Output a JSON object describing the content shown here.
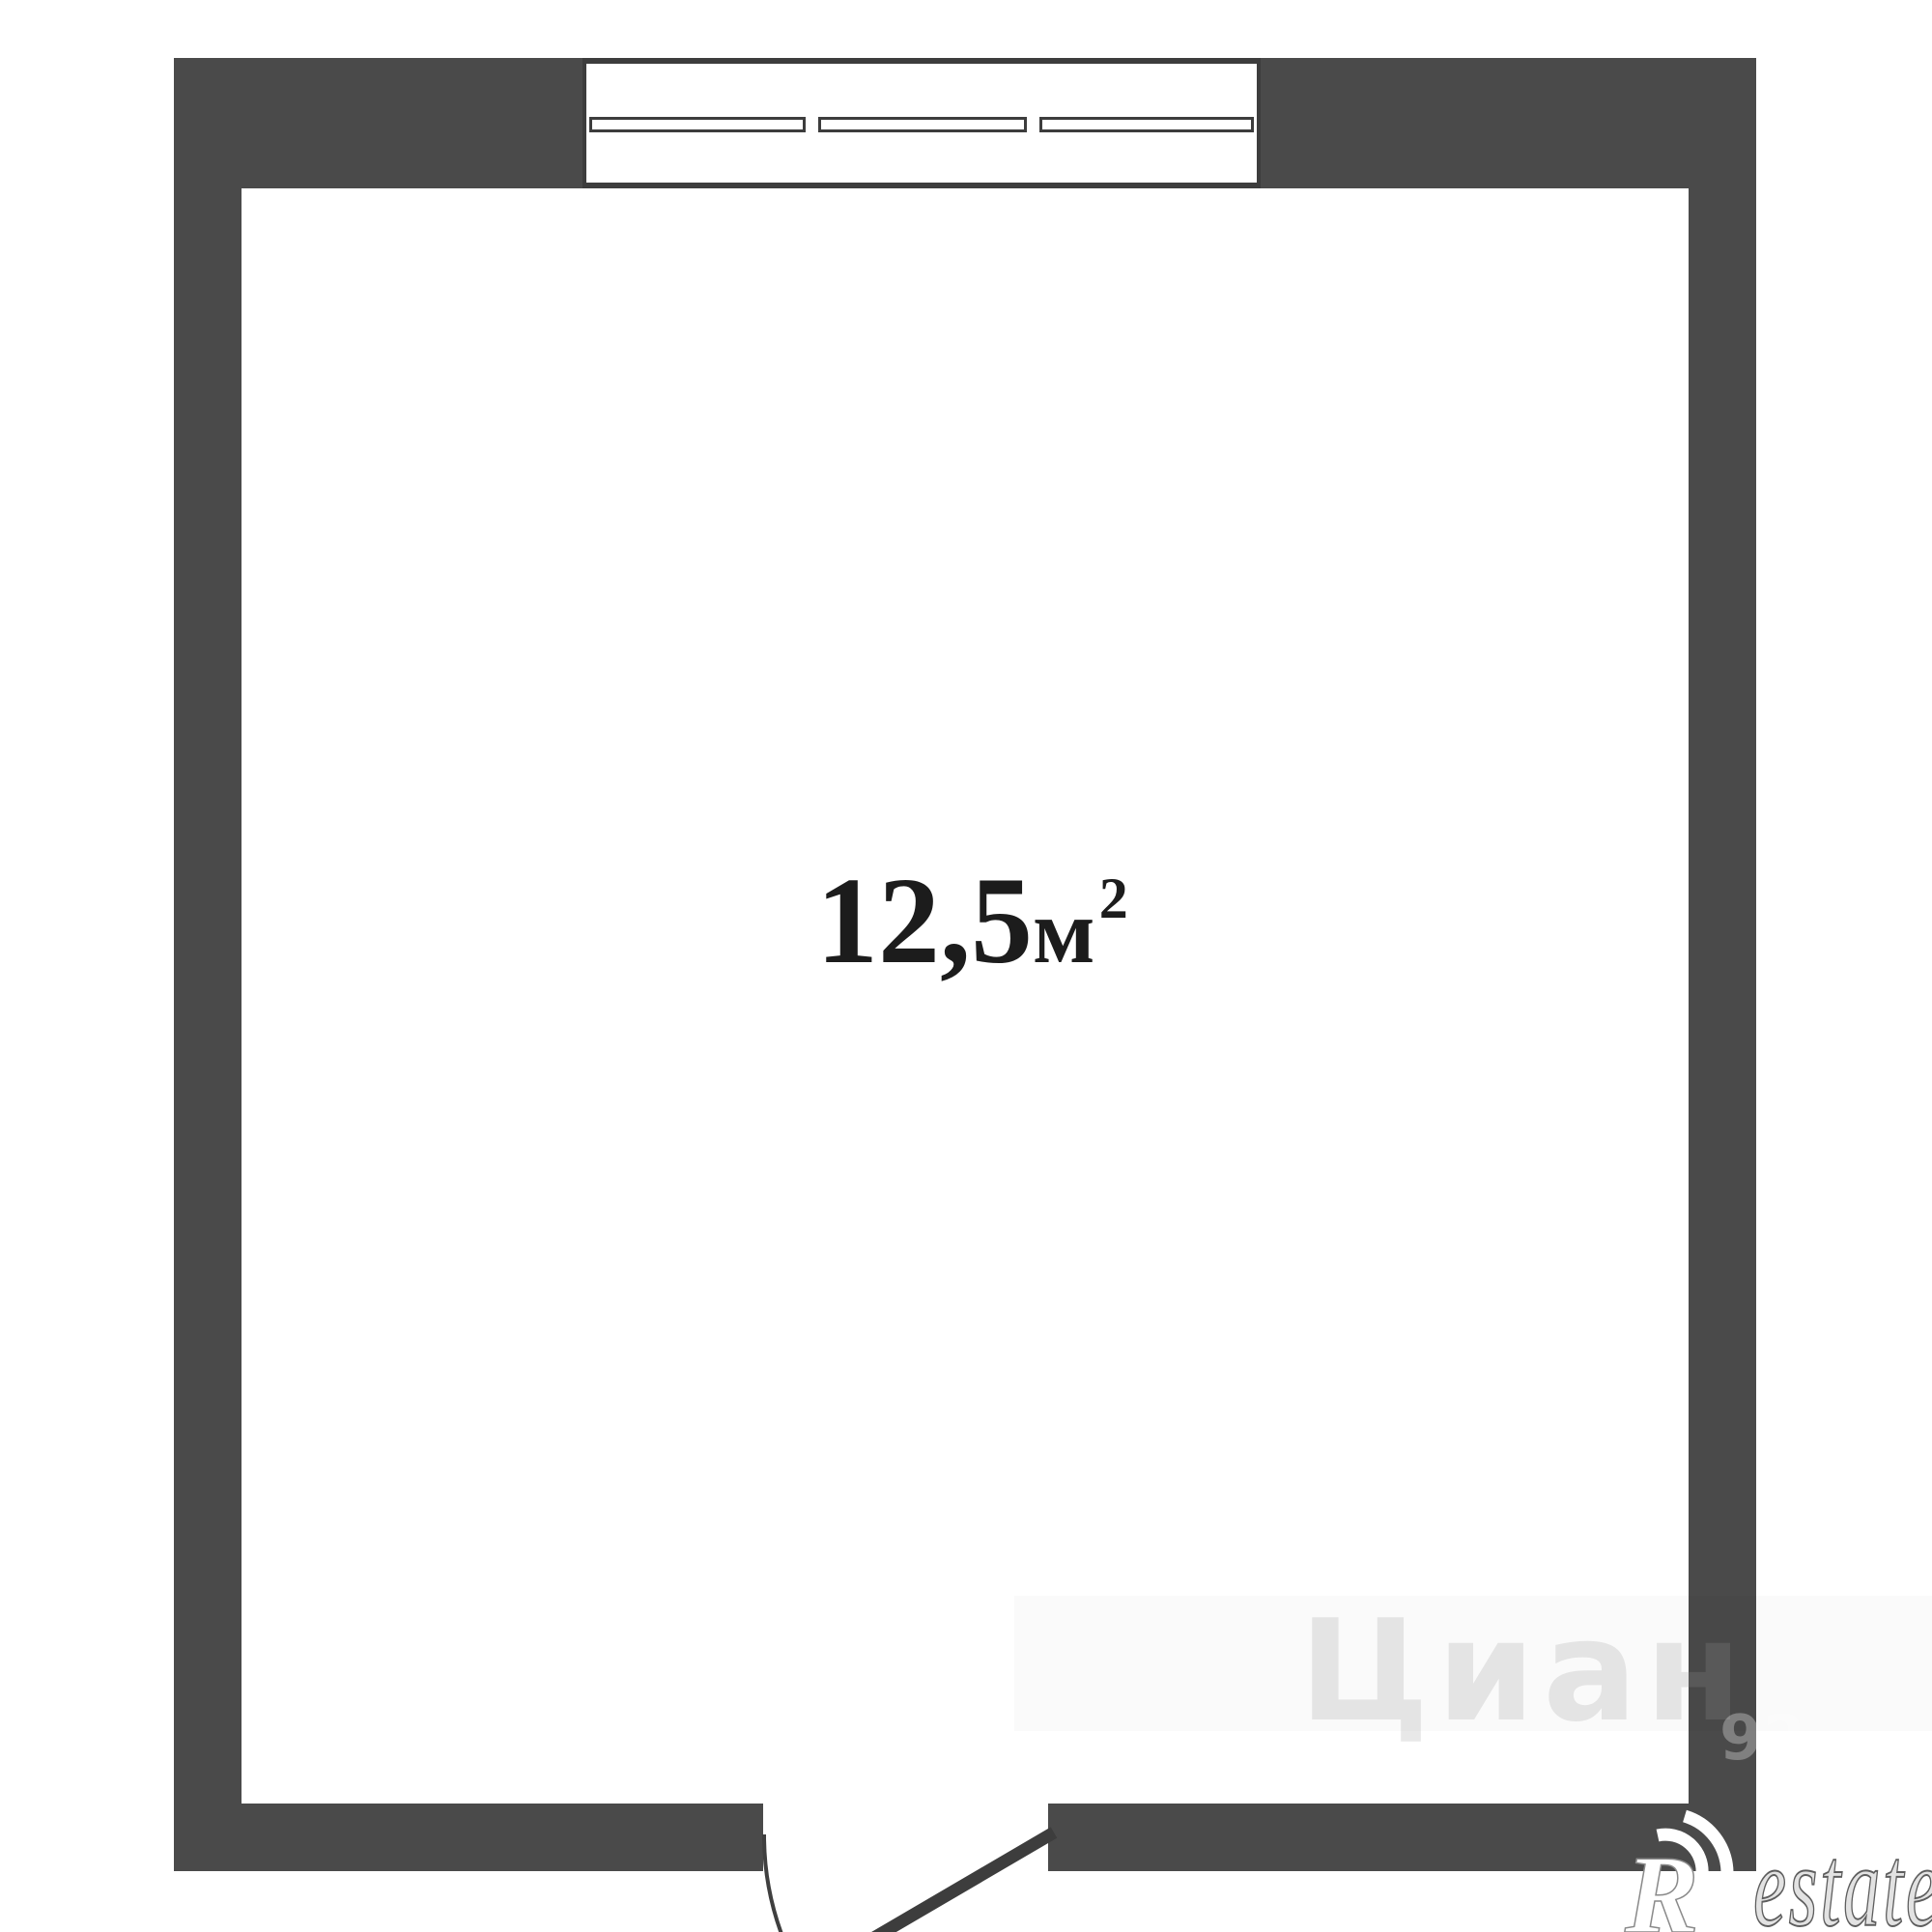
{
  "plan": {
    "title": "room floor plan",
    "area_label": {
      "value": "12,5",
      "unit": "м",
      "exponent": "2"
    },
    "colors": {
      "wall": "#4a4a4a",
      "outline": "#3d3d3d",
      "background": "#ffffff",
      "label_text": "#1c1c1c"
    },
    "window": {
      "pane_count": 3
    },
    "watermarks": {
      "portal_name": "Циан",
      "portal_number": "92",
      "agency_initial": "R",
      "agency_rest": "estate"
    }
  }
}
